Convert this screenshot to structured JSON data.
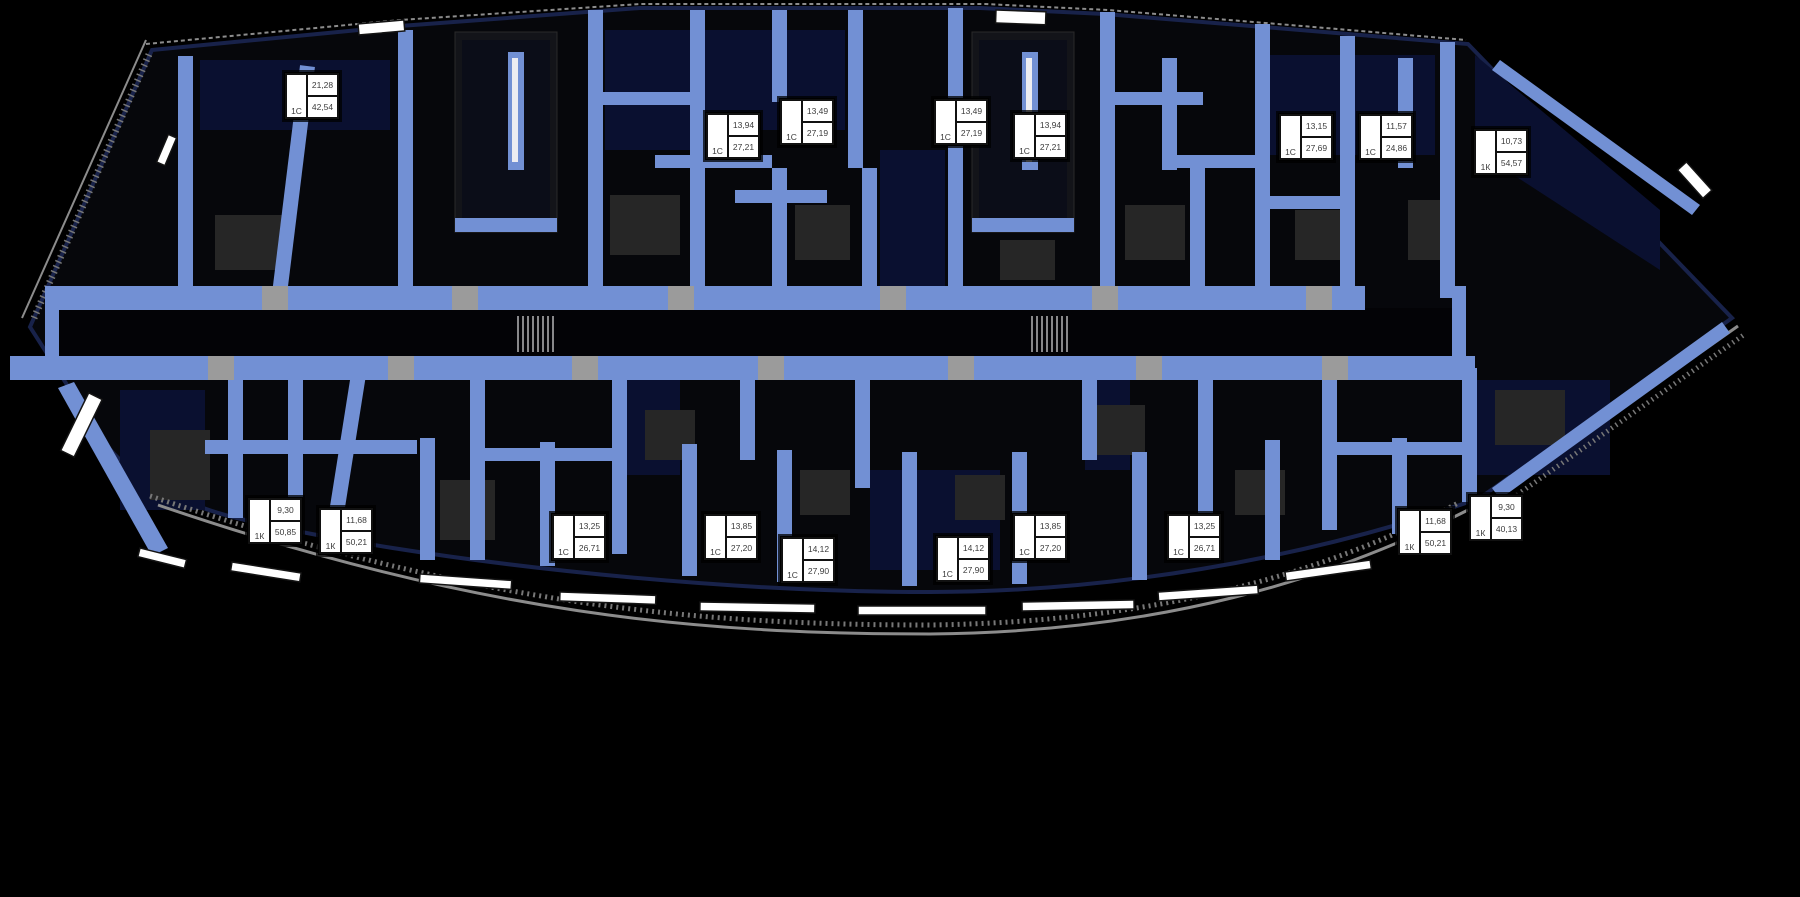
{
  "plan": {
    "name": "Residential floor plan",
    "colors": {
      "background": "#000000",
      "wall": "#7290D4",
      "floor": "#06070B",
      "room": "#0A1030",
      "rim": "#18224A",
      "window": "#FFFFFF",
      "rail": "#8C8C8C",
      "threshold": "#9B9B9B",
      "furniture": "#262626",
      "label_bg": "#FFFFFF",
      "label_border": "#111111",
      "label_text": "#3B3B3B"
    },
    "units": [
      {
        "type": "1С",
        "room_area": "21,28",
        "total_area": "42,54",
        "x": 284,
        "y": 72
      },
      {
        "type": "1С",
        "room_area": "13,94",
        "total_area": "27,21",
        "x": 705,
        "y": 112
      },
      {
        "type": "1С",
        "room_area": "13,49",
        "total_area": "27,19",
        "x": 779,
        "y": 98
      },
      {
        "type": "1С",
        "room_area": "13,49",
        "total_area": "27,19",
        "x": 933,
        "y": 98
      },
      {
        "type": "1С",
        "room_area": "13,94",
        "total_area": "27,21",
        "x": 1012,
        "y": 112
      },
      {
        "type": "1С",
        "room_area": "13,15",
        "total_area": "27,69",
        "x": 1278,
        "y": 113
      },
      {
        "type": "1С",
        "room_area": "11,57",
        "total_area": "24,86",
        "x": 1358,
        "y": 113
      },
      {
        "type": "1К",
        "room_area": "10,73",
        "total_area": "54,57",
        "x": 1473,
        "y": 128
      },
      {
        "type": "1К",
        "room_area": "9,30",
        "total_area": "50,85",
        "x": 247,
        "y": 497
      },
      {
        "type": "1К",
        "room_area": "11,68",
        "total_area": "50,21",
        "x": 318,
        "y": 507
      },
      {
        "type": "1С",
        "room_area": "13,25",
        "total_area": "26,71",
        "x": 551,
        "y": 513
      },
      {
        "type": "1С",
        "room_area": "13,85",
        "total_area": "27,20",
        "x": 703,
        "y": 513
      },
      {
        "type": "1С",
        "room_area": "14,12",
        "total_area": "27,90",
        "x": 780,
        "y": 536
      },
      {
        "type": "1С",
        "room_area": "14,12",
        "total_area": "27,90",
        "x": 935,
        "y": 535
      },
      {
        "type": "1С",
        "room_area": "13,85",
        "total_area": "27,20",
        "x": 1012,
        "y": 513
      },
      {
        "type": "1С",
        "room_area": "13,25",
        "total_area": "26,71",
        "x": 1166,
        "y": 513
      },
      {
        "type": "1К",
        "room_area": "11,68",
        "total_area": "50,21",
        "x": 1397,
        "y": 508
      },
      {
        "type": "1К",
        "room_area": "9,30",
        "total_area": "40,13",
        "x": 1468,
        "y": 494
      }
    ]
  }
}
